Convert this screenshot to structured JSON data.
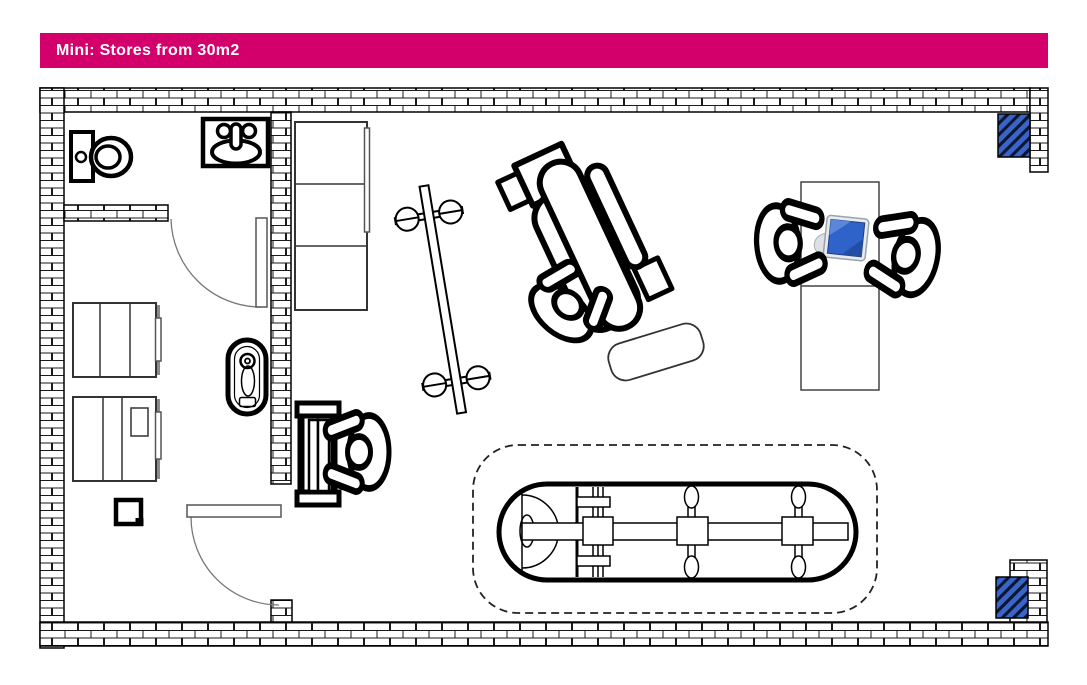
{
  "header": {
    "title": "Mini: Stores from 30m2"
  },
  "colors": {
    "header_bg": "#D3006C",
    "header_text": "#FFFFFF",
    "wall_line": "#000000",
    "brick_fill": "#FFFFFF",
    "column_blue": "#3A64C8",
    "column_hatch_dark": "#0A1530",
    "door_line": "#666666",
    "desk_line": "#444444",
    "cabinet_shadow": "#8A8A8A",
    "computer_screen_blue": "#2F63C9",
    "computer_screen_highlight": "#5B87D8",
    "computer_screen_shadow": "#244EA3",
    "computer_body_gray": "#E8EBEE"
  },
  "floorplan": {
    "icons": [
      "toilet-icon",
      "sink-icon",
      "bathroom-door-icon",
      "entrance-door-icon",
      "cabinet-icon",
      "small-box-icon",
      "water-heater-icon",
      "wall-shelf-icon",
      "display-rack-icon",
      "clothes-rail-icon",
      "treatment-chair-icon",
      "person-top-view-icon",
      "chair-mat-icon",
      "sunbed-icon",
      "sunbed-clearance-zone-icon",
      "reception-desk-icon",
      "computer-icon",
      "brick-wall-texture",
      "blue-column-icon"
    ],
    "people_count": 4
  }
}
